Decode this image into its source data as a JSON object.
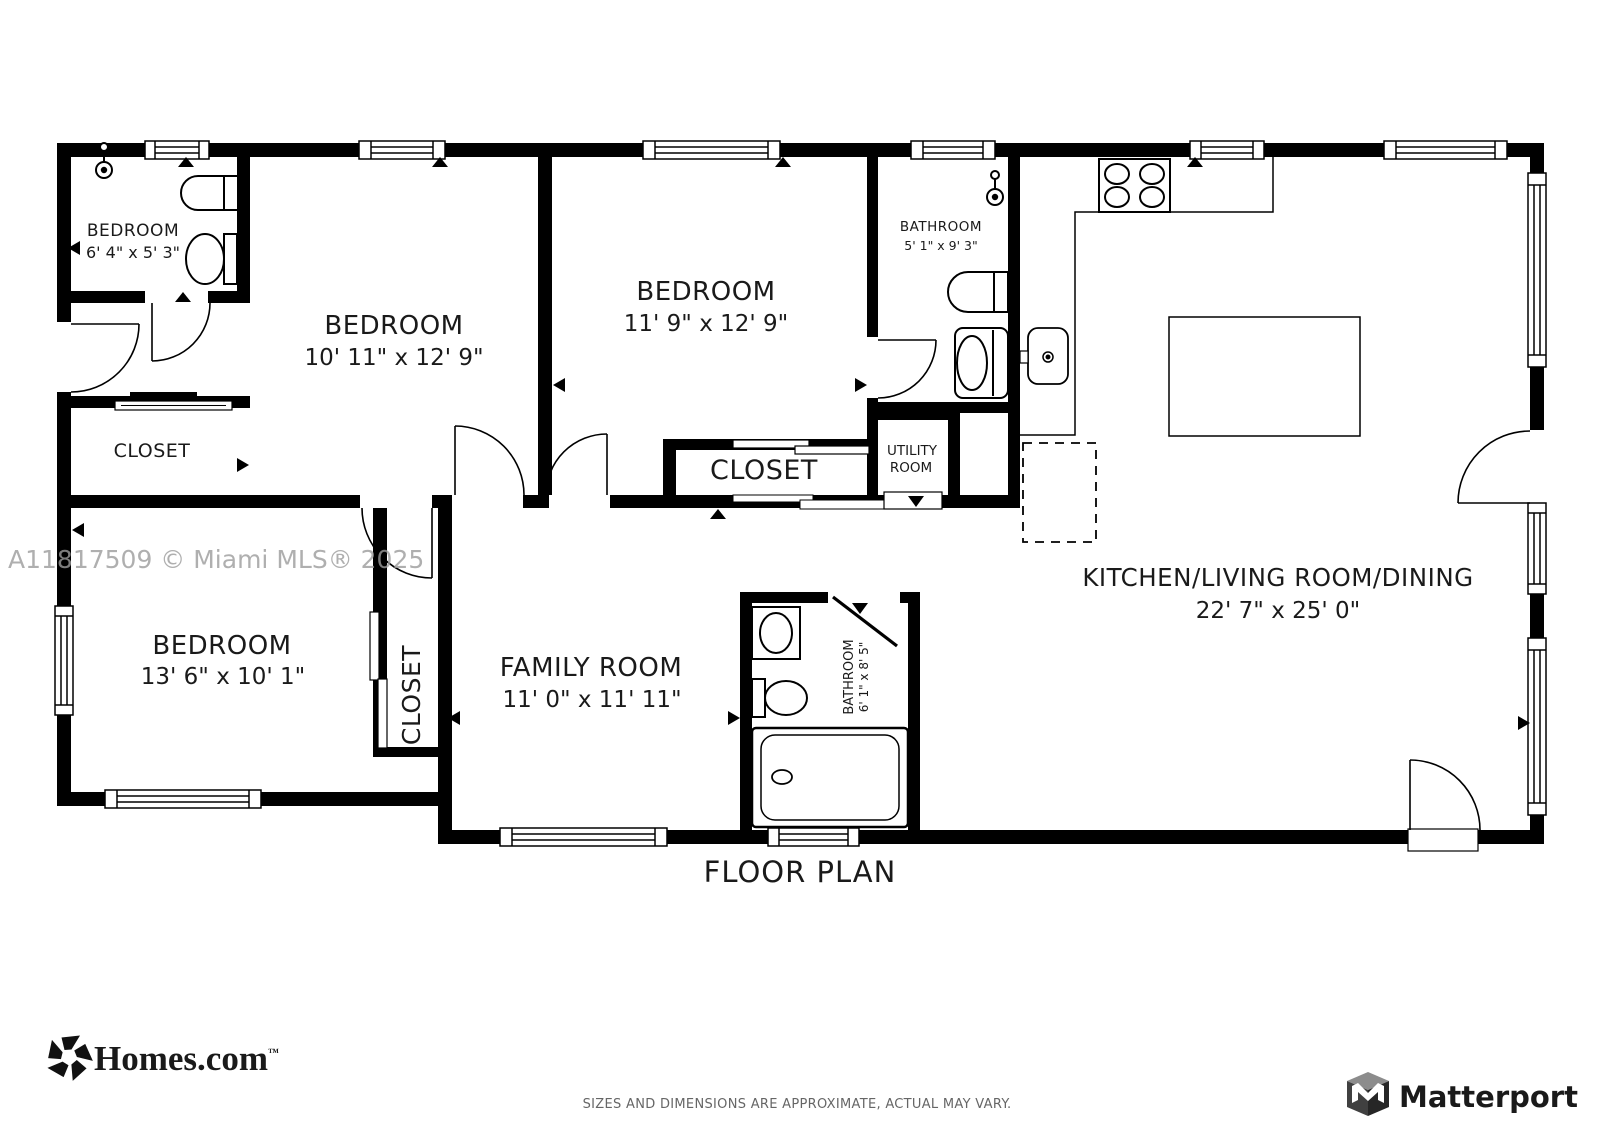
{
  "floor_plan": {
    "title": "FLOOR PLAN",
    "watermark": "A11817509 © Miami MLS® 2025",
    "disclaimer": "SIZES AND DIMENSIONS ARE APPROXIMATE, ACTUAL MAY VARY.",
    "colors": {
      "wall": "#000000",
      "label": "#1a1a1a",
      "watermark": "#9c9c9c"
    },
    "rooms": {
      "bedroom_small": {
        "name": "BEDROOM",
        "dims": "6' 4\" x 5' 3\""
      },
      "bedroom_1": {
        "name": "BEDROOM",
        "dims": "10' 11\" x 12' 9\""
      },
      "bedroom_2": {
        "name": "BEDROOM",
        "dims": "11' 9\" x 12' 9\""
      },
      "bedroom_3": {
        "name": "BEDROOM",
        "dims": "13' 6\" x 10' 1\""
      },
      "bathroom_1": {
        "name": "BATHROOM",
        "dims": "5' 1\" x 9' 3\""
      },
      "bathroom_2": {
        "name": "BATHROOM",
        "dims": "6' 1\" x 8' 5\""
      },
      "closet_1": {
        "name": "CLOSET"
      },
      "closet_2": {
        "name": "CLOSET"
      },
      "closet_3": {
        "name": "CLOSET"
      },
      "utility": {
        "name_line1": "UTILITY",
        "name_line2": "ROOM"
      },
      "kitchen_living_dining": {
        "name": "KITCHEN/LIVING ROOM/DINING",
        "dims": "22' 7\" x 25' 0\""
      },
      "family_room": {
        "name": "FAMILY ROOM",
        "dims": "11' 0\" x 11' 11\""
      }
    },
    "branding": {
      "homes_logo_text": "Homes.com",
      "homes_tm": "™",
      "matterport_logo_text": "Matterport"
    }
  }
}
